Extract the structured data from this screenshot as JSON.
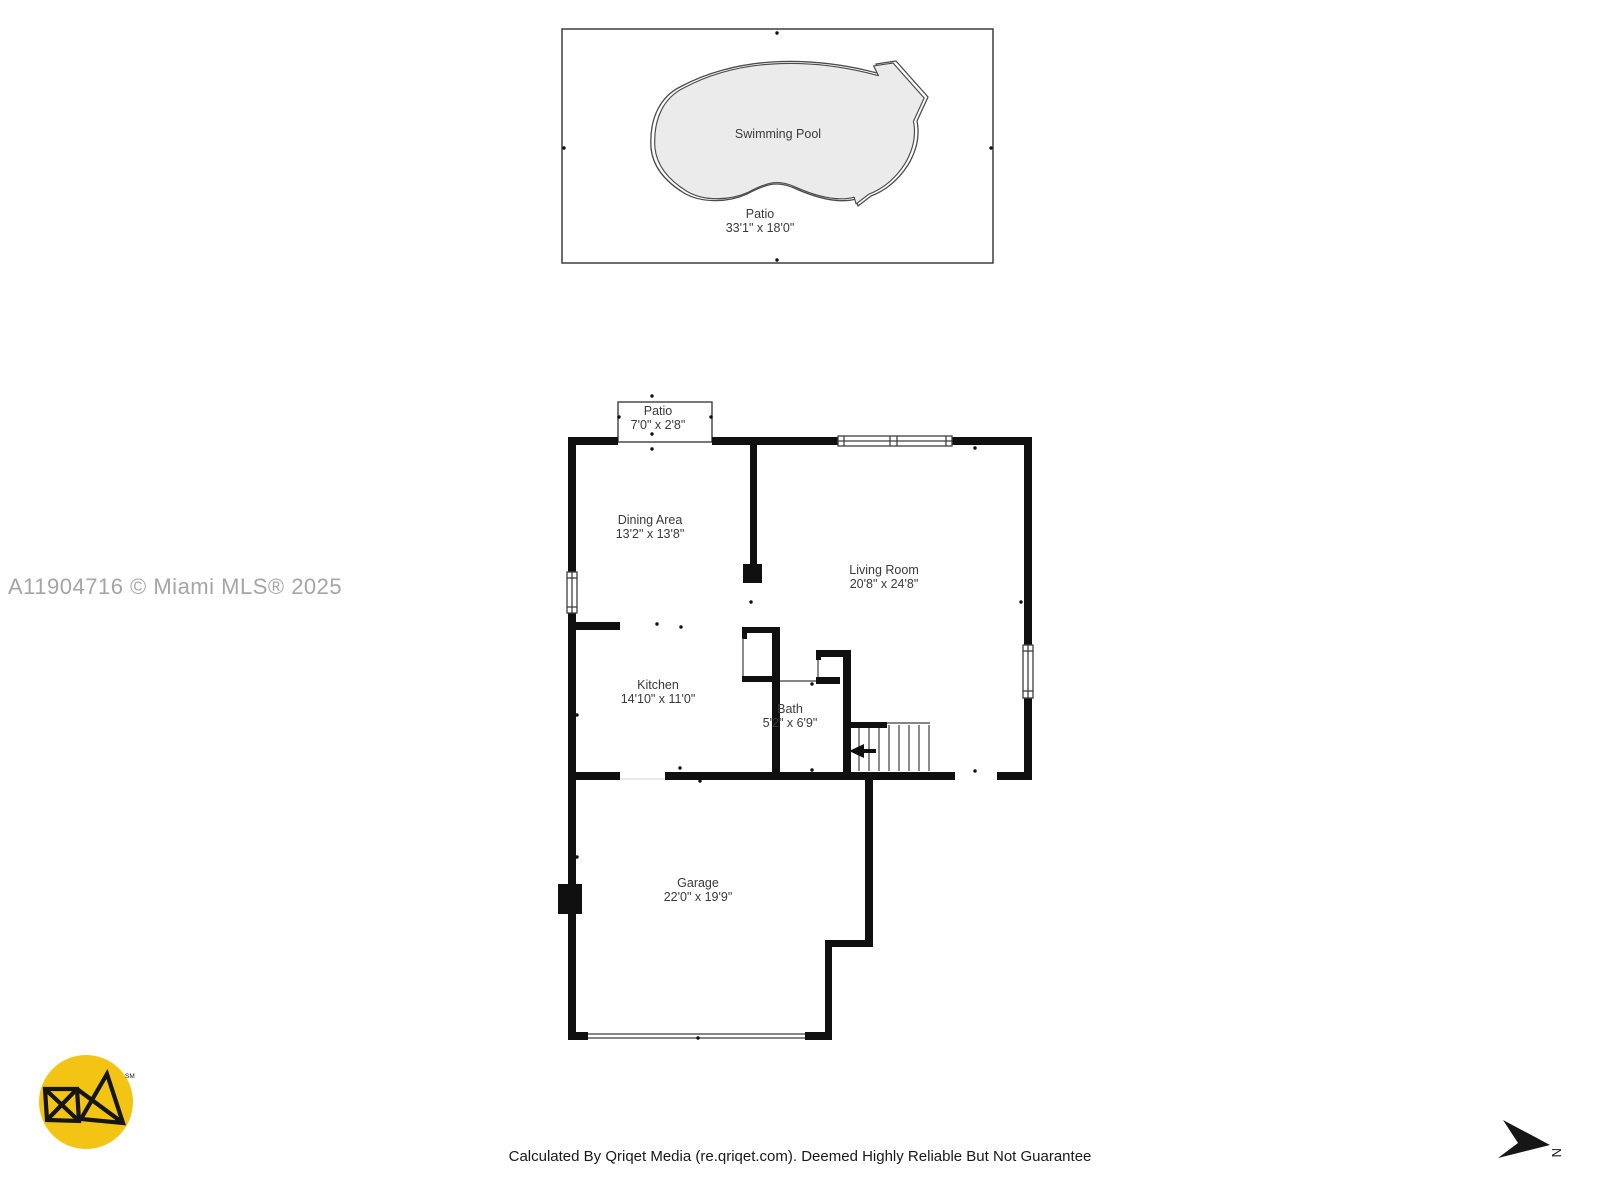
{
  "watermark": "A11904716 © Miami MLS® 2025",
  "disclaimer": "Calculated By Qriqet Media (re.qriqet.com). Deemed Highly Reliable But Not Guarantee",
  "compass": {
    "label": "N"
  },
  "logo": {
    "trademark": "SM",
    "background_color": "#F3C413",
    "mark_color": "#151515"
  },
  "colors": {
    "wall": "#101010",
    "thin_line": "#3f3f3f",
    "pool_fill": "#ebebeb",
    "label_text": "#3a3a3a",
    "watermark_text": "#a5a5a5",
    "disclaimer_text": "#191919"
  },
  "pool_area": {
    "pool_label": "Swimming Pool",
    "patio": {
      "name": "Patio",
      "dimensions": "33'1\" x 18'0\""
    }
  },
  "rooms": [
    {
      "id": "patio",
      "name": "Patio",
      "dimensions": "7'0\" x 2'8\""
    },
    {
      "id": "dining-area",
      "name": "Dining Area",
      "dimensions": "13'2\" x 13'8\""
    },
    {
      "id": "living-room",
      "name": "Living Room",
      "dimensions": "20'8\" x 24'8\""
    },
    {
      "id": "kitchen",
      "name": "Kitchen",
      "dimensions": "14'10\" x 11'0\""
    },
    {
      "id": "bath",
      "name": "Bath",
      "dimensions": "5'2\" x 6'9\""
    },
    {
      "id": "garage",
      "name": "Garage",
      "dimensions": "22'0\" x 19'9\""
    }
  ]
}
